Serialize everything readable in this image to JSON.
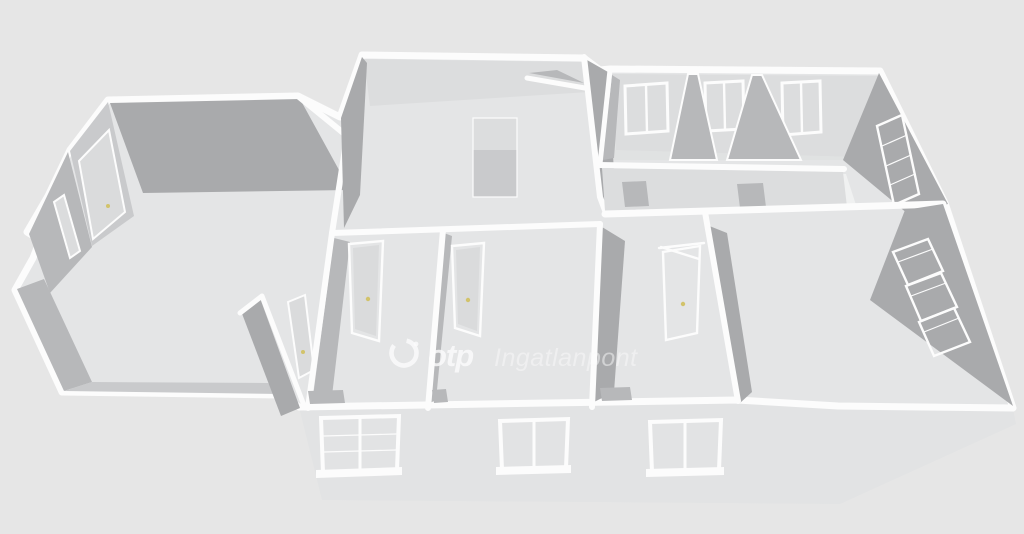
{
  "scene": {
    "kind": "3d-floorplan-render",
    "watermark": {
      "logo": "otp-ring-logo",
      "brand_bold": "otp",
      "brand_light": "Ingatlanpont"
    },
    "features": {
      "back_wall_windows": 3,
      "facade_windows": 3,
      "shuttered_wall_windows": 2,
      "interior_doors_with_gold_handles": 6,
      "hallway_door_openings": 2
    }
  },
  "colors": {
    "background": "#e6e6e6",
    "wall_top": "#fcfcfc",
    "floor": "#e4e5e6",
    "floor_light": "#f0f1f1",
    "facade": "#e2e3e4",
    "face_dark": "#a9aaac",
    "face_mid": "#b7b8ba",
    "face_light": "#c9cacc",
    "face_pale": "#dcddde",
    "window_pane": "#ced0d2",
    "pane_light": "#dbdcdd",
    "shutter": "#a2a3a5",
    "door_panel": "#dadbdc",
    "handle_gold": "#d2c36b",
    "wm_bright": "rgba(252,252,252,0.78)",
    "wm_soft": "rgba(250,250,250,0.5)"
  }
}
